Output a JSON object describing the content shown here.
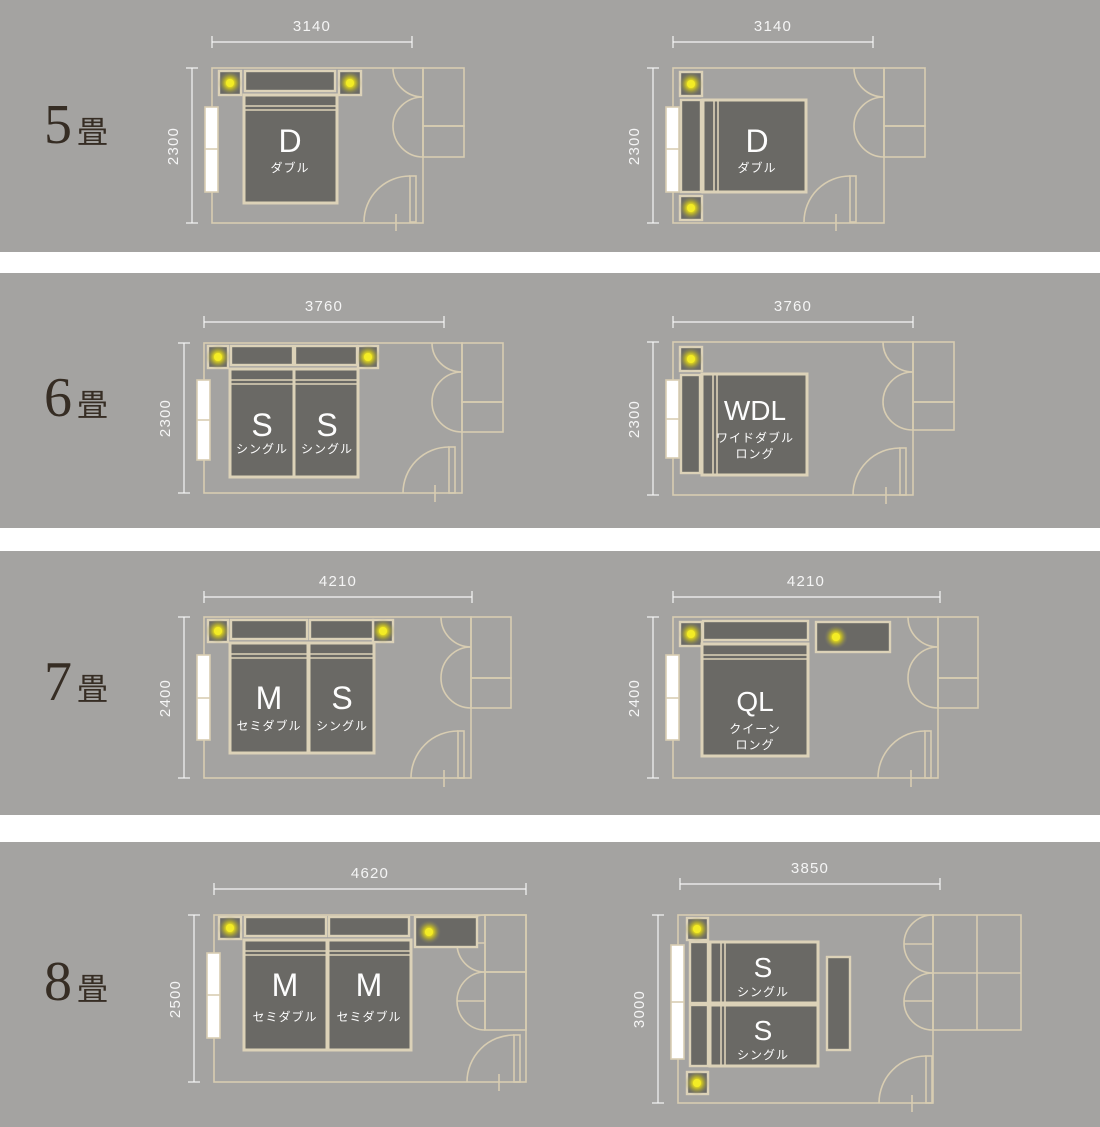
{
  "title": "畳数別ベッドレイアウト図",
  "colors": {
    "band_bg": "#a4a3a1",
    "wall_beige": "#d8cdb2",
    "furniture_fill": "#6a6965",
    "furniture_border": "#dcd2b8",
    "lamp_yellow": "#f0e71c",
    "dim_white": "#f5f5f5",
    "row_label_dark": "#362d24",
    "bed_text_white": "#fdfdfd"
  },
  "rows": [
    {
      "label_num": "5",
      "label_unit": "畳",
      "plans": [
        {
          "width_label": "3140",
          "height_label": "2300",
          "beds": [
            {
              "code": "D",
              "name_lines": [
                "ダブル"
              ]
            }
          ]
        },
        {
          "width_label": "3140",
          "height_label": "2300",
          "beds": [
            {
              "code": "D",
              "name_lines": [
                "ダブル"
              ]
            }
          ]
        }
      ]
    },
    {
      "label_num": "6",
      "label_unit": "畳",
      "plans": [
        {
          "width_label": "3760",
          "height_label": "2300",
          "beds": [
            {
              "code": "S",
              "name_lines": [
                "シングル"
              ]
            },
            {
              "code": "S",
              "name_lines": [
                "シングル"
              ]
            }
          ]
        },
        {
          "width_label": "3760",
          "height_label": "2300",
          "beds": [
            {
              "code": "WDL",
              "name_lines": [
                "ワイドダブル",
                "ロング"
              ]
            }
          ]
        }
      ]
    },
    {
      "label_num": "7",
      "label_unit": "畳",
      "plans": [
        {
          "width_label": "4210",
          "height_label": "2400",
          "beds": [
            {
              "code": "M",
              "name_lines": [
                "セミダブル"
              ]
            },
            {
              "code": "S",
              "name_lines": [
                "シングル"
              ]
            }
          ]
        },
        {
          "width_label": "4210",
          "height_label": "2400",
          "beds": [
            {
              "code": "QL",
              "name_lines": [
                "クイーン",
                "ロング"
              ]
            }
          ]
        }
      ]
    },
    {
      "label_num": "8",
      "label_unit": "畳",
      "plans": [
        {
          "width_label": "4620",
          "height_label": "2500",
          "beds": [
            {
              "code": "M",
              "name_lines": [
                "セミダブル"
              ]
            },
            {
              "code": "M",
              "name_lines": [
                "セミダブル"
              ]
            }
          ]
        },
        {
          "width_label": "3850",
          "height_label": "3000",
          "beds": [
            {
              "code": "S",
              "name_lines": [
                "シングル"
              ]
            },
            {
              "code": "S",
              "name_lines": [
                "シングル"
              ]
            }
          ]
        }
      ]
    }
  ]
}
